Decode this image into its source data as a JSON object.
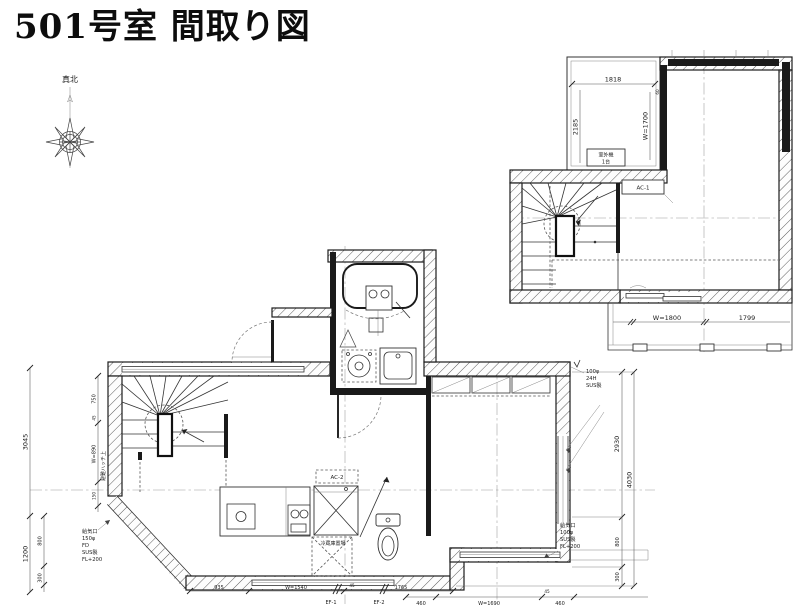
{
  "title": "501号室 間取り図",
  "compass": {
    "north_label": "真北"
  },
  "upper_plan": {
    "dims": {
      "top_width": "1818",
      "left_height": "2185",
      "right_window": "W=1700",
      "offset": "60",
      "balcony_window": "W=1800",
      "balcony_right": "1799"
    },
    "labels": {
      "outdoor_unit": "室外機",
      "outdoor_unit_count": "1台",
      "ac": "AC-1"
    }
  },
  "main_plan": {
    "labels": {
      "ac": "AC-2",
      "fridge": "冷蔵庫置場",
      "hatch_note": "避難ハッチ上",
      "fan_1": "EF-1",
      "fan_2": "EF-2",
      "vent_note_top_right": {
        "l1": "100φ",
        "l2": "24H",
        "l3": "SUS製"
      },
      "supply_vent_left": {
        "l1": "給気口",
        "l2": "150φ",
        "l3": "FD",
        "l4": "SUS製",
        "l5": "FL+200"
      },
      "supply_vent_right": {
        "l1": "給気口",
        "l2": "100φ",
        "l3": "SUS製",
        "l4": "FL+200"
      }
    },
    "dims": {
      "left_upper": "3045",
      "left_lower": "1200",
      "left_800": "800",
      "left_300": "300",
      "stair_750": "750",
      "stair_45": "45",
      "stair_window": "W=890",
      "stair_150": "150",
      "right_upper": "2930",
      "right_total": "4030",
      "right_800": "800",
      "right_300": "300",
      "bottom_935": "935",
      "bottom_window_left": "W=1540",
      "bottom_45a": "45",
      "bottom_1765": "1765",
      "bottom_460a": "460",
      "bottom_window_right": "W=1690",
      "bottom_45b": "45",
      "bottom_460b": "460"
    }
  }
}
